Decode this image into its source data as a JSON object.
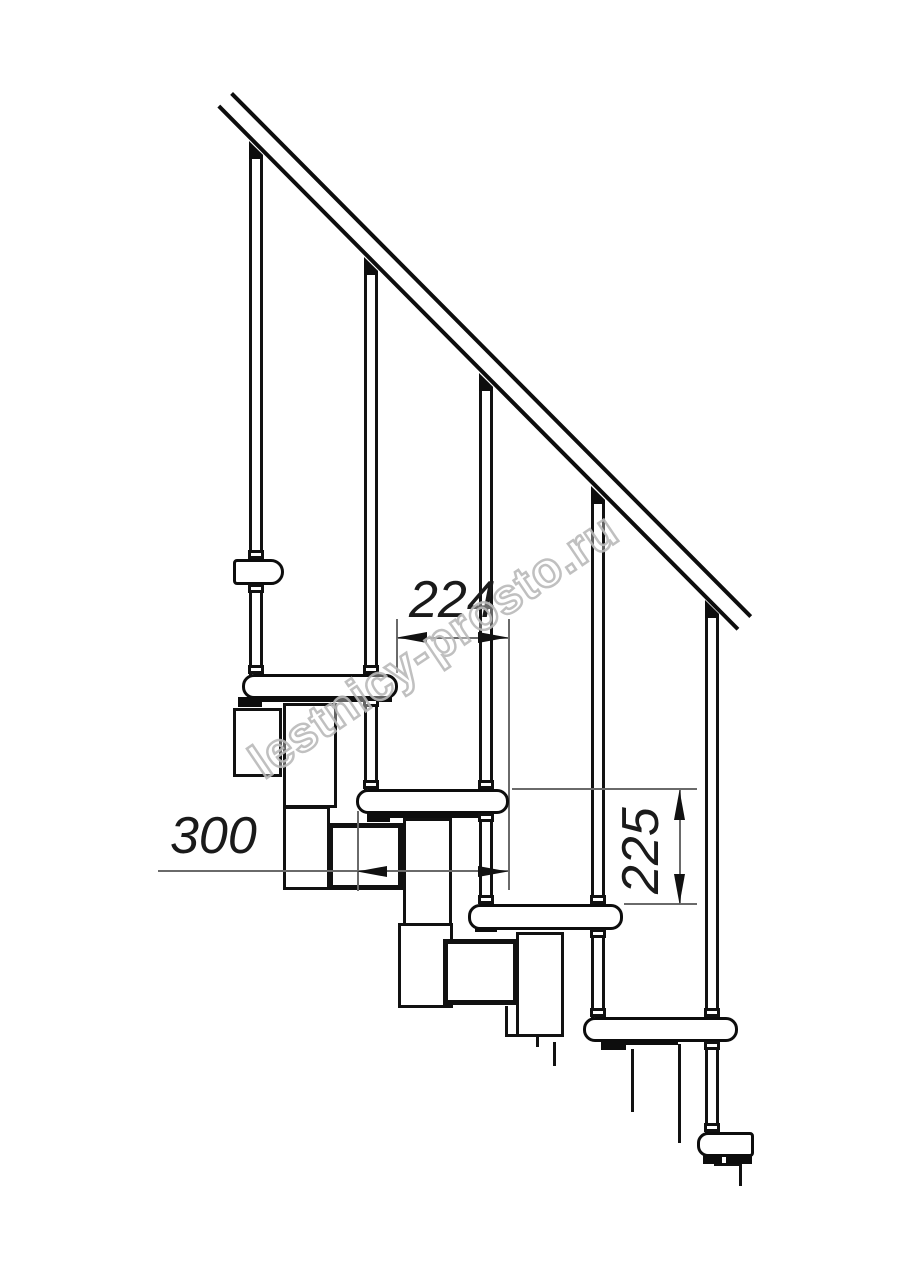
{
  "title": "Modular staircase side-view technical drawing",
  "watermark": "lestnicy-prosto.ru",
  "dimensions": {
    "step_run": {
      "label": "224",
      "orientation": "horizontal"
    },
    "tread_depth": {
      "label": "300",
      "orientation": "horizontal"
    },
    "riser_height": {
      "label": "225",
      "orientation": "vertical"
    }
  },
  "drawing": {
    "treads_count": 6,
    "balusters_count": 5,
    "line_color": "#111111",
    "dimension_line_color": "#6a6a6a",
    "watermark_color": "#b9b9b9",
    "background": "#ffffff"
  }
}
